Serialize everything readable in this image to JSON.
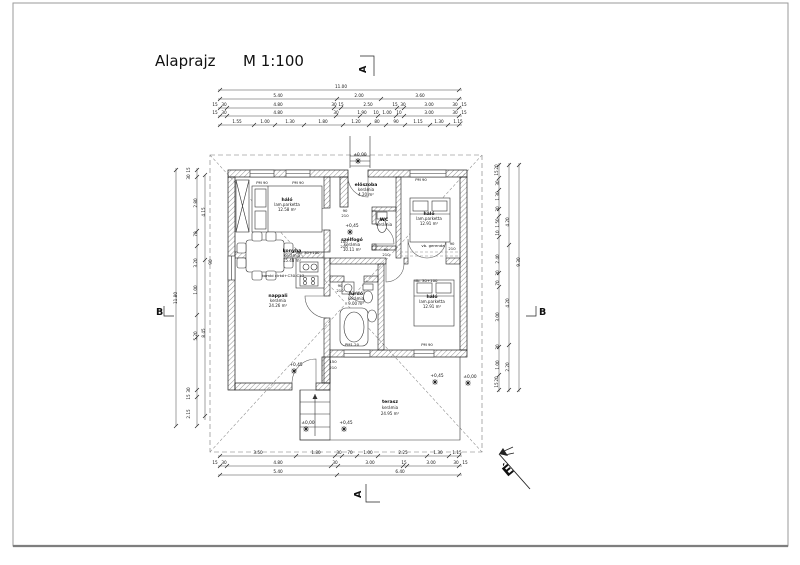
{
  "title": {
    "name": "Alaprajz",
    "scale": "M 1:100"
  },
  "section_labels": {
    "a": "A",
    "b": "B"
  },
  "north_label": "É",
  "rooms": [
    {
      "name": "háló",
      "floor": "lam.parketta",
      "area": "12.58 m²"
    },
    {
      "name": "előszoba",
      "floor": "kerámia",
      "area": "4.20 m²"
    },
    {
      "name": "háló",
      "floor": "lam.parketta",
      "area": "12.91 m²"
    },
    {
      "name": "WC",
      "floor": "kerámia",
      "area": ""
    },
    {
      "name": "szélfogó",
      "floor": "kerámia",
      "area": "10.11 m²"
    },
    {
      "name": "konyha",
      "floor": "kerámia",
      "area": "15.48 m²"
    },
    {
      "name": "nappali",
      "floor": "kerámia",
      "area": "24.26 m²"
    },
    {
      "name": "fürdő",
      "floor": "kerámia",
      "area": "9.00 m²"
    },
    {
      "name": "háló",
      "floor": "lam.parketta",
      "area": "12.91 m²"
    },
    {
      "name": "terasz",
      "floor": "kerámia",
      "area": "24.95 m²"
    }
  ],
  "window_labels": [
    {
      "t": "PM 90",
      "x": 262,
      "y": 184
    },
    {
      "t": "PM 90",
      "x": 298,
      "y": 184
    },
    {
      "t": "PM 90",
      "x": 421,
      "y": 181
    },
    {
      "t": "PM1.20",
      "x": 352,
      "y": 346
    },
    {
      "t": "PM 90",
      "x": 427,
      "y": 346
    }
  ],
  "elevation_marks": [
    {
      "t": "±0,00",
      "x": 360,
      "y": 156
    },
    {
      "t": "+0,45",
      "x": 352,
      "y": 227
    },
    {
      "t": "+0,45",
      "x": 296,
      "y": 366
    },
    {
      "t": "±0,00",
      "x": 308,
      "y": 424
    },
    {
      "t": "+0,45",
      "x": 346,
      "y": 424
    },
    {
      "t": "+0,45",
      "x": 437,
      "y": 377
    },
    {
      "t": "±0,00",
      "x": 470,
      "y": 378
    }
  ],
  "notes": [
    {
      "t": "vb. gerenda",
      "x": 433,
      "y": 247
    },
    {
      "t": "db. 30+100",
      "x": 308,
      "y": 254
    },
    {
      "t": "db. 30+100",
      "x": 426,
      "y": 282
    },
    {
      "t": "kombi cirkó+C30-C53",
      "x": 283,
      "y": 277
    }
  ],
  "door_sizes": [
    {
      "t": "90",
      "x": 345,
      "y": 212
    },
    {
      "t": "210",
      "x": 345,
      "y": 217
    },
    {
      "t": "100",
      "x": 344,
      "y": 243
    },
    {
      "t": "210",
      "x": 344,
      "y": 248
    },
    {
      "t": "90",
      "x": 386,
      "y": 251
    },
    {
      "t": "210",
      "x": 386,
      "y": 256
    },
    {
      "t": "90",
      "x": 452,
      "y": 245
    },
    {
      "t": "210",
      "x": 452,
      "y": 250
    },
    {
      "t": "90",
      "x": 340,
      "y": 287
    },
    {
      "t": "210",
      "x": 340,
      "y": 292
    },
    {
      "t": "150",
      "x": 333,
      "y": 363
    },
    {
      "t": "210",
      "x": 333,
      "y": 369
    }
  ],
  "dim_labels_h": [
    {
      "t": "11.00",
      "x": 341,
      "y": 88
    },
    {
      "t": "5.40",
      "x": 278,
      "y": 97
    },
    {
      "t": "2.00",
      "x": 359,
      "y": 97
    },
    {
      "t": "3.60",
      "x": 420,
      "y": 97
    },
    {
      "t": "15",
      "x": 215,
      "y": 106
    },
    {
      "t": "30",
      "x": 224,
      "y": 106
    },
    {
      "t": "4.80",
      "x": 278,
      "y": 106
    },
    {
      "t": "30",
      "x": 334,
      "y": 106
    },
    {
      "t": "15",
      "x": 341,
      "y": 106
    },
    {
      "t": "2.50",
      "x": 368,
      "y": 106
    },
    {
      "t": "15",
      "x": 395,
      "y": 106
    },
    {
      "t": "30",
      "x": 403,
      "y": 106
    },
    {
      "t": "3.00",
      "x": 429,
      "y": 106
    },
    {
      "t": "30",
      "x": 455,
      "y": 106
    },
    {
      "t": "15",
      "x": 464,
      "y": 106
    },
    {
      "t": "15",
      "x": 215,
      "y": 114
    },
    {
      "t": "30",
      "x": 224,
      "y": 114
    },
    {
      "t": "4.80",
      "x": 278,
      "y": 114
    },
    {
      "t": "30",
      "x": 336,
      "y": 114
    },
    {
      "t": "1.90",
      "x": 362,
      "y": 114
    },
    {
      "t": "10",
      "x": 376,
      "y": 114
    },
    {
      "t": "1.00",
      "x": 387,
      "y": 114
    },
    {
      "t": "10",
      "x": 399,
      "y": 114
    },
    {
      "t": "3.00",
      "x": 429,
      "y": 114
    },
    {
      "t": "30",
      "x": 455,
      "y": 114
    },
    {
      "t": "15",
      "x": 464,
      "y": 114
    },
    {
      "t": "1.55",
      "x": 237,
      "y": 123
    },
    {
      "t": "1.00",
      "x": 265,
      "y": 123
    },
    {
      "t": "1.30",
      "x": 290,
      "y": 123
    },
    {
      "t": "1.80",
      "x": 323,
      "y": 123
    },
    {
      "t": "1.20",
      "x": 356,
      "y": 123
    },
    {
      "t": "80",
      "x": 377,
      "y": 123
    },
    {
      "t": "90",
      "x": 396,
      "y": 123
    },
    {
      "t": "1.15",
      "x": 418,
      "y": 123
    },
    {
      "t": "1.30",
      "x": 439,
      "y": 123
    },
    {
      "t": "1.15",
      "x": 458,
      "y": 123
    },
    {
      "t": "3.50",
      "x": 258,
      "y": 454
    },
    {
      "t": "1.80",
      "x": 316,
      "y": 454
    },
    {
      "t": "30",
      "x": 339,
      "y": 454
    },
    {
      "t": "70",
      "x": 350,
      "y": 454
    },
    {
      "t": "1.00",
      "x": 368,
      "y": 454
    },
    {
      "t": "2.25",
      "x": 403,
      "y": 454
    },
    {
      "t": "1.30",
      "x": 438,
      "y": 454
    },
    {
      "t": "1.15",
      "x": 457,
      "y": 454
    },
    {
      "t": "15",
      "x": 215,
      "y": 464
    },
    {
      "t": "30",
      "x": 224,
      "y": 464
    },
    {
      "t": "4.80",
      "x": 278,
      "y": 464
    },
    {
      "t": "30",
      "x": 335,
      "y": 464
    },
    {
      "t": "3.00",
      "x": 370,
      "y": 464
    },
    {
      "t": "15",
      "x": 404,
      "y": 464
    },
    {
      "t": "3.00",
      "x": 431,
      "y": 464
    },
    {
      "t": "30",
      "x": 456,
      "y": 464
    },
    {
      "t": "15",
      "x": 465,
      "y": 464
    },
    {
      "t": "5.40",
      "x": 278,
      "y": 473
    },
    {
      "t": "6.40",
      "x": 400,
      "y": 473
    }
  ],
  "dim_labels_v": [
    {
      "t": "11.80",
      "x": 177,
      "y": 298
    },
    {
      "t": "15",
      "x": 190,
      "y": 170
    },
    {
      "t": "30",
      "x": 190,
      "y": 177
    },
    {
      "t": "2.80",
      "x": 197,
      "y": 203
    },
    {
      "t": "70",
      "x": 197,
      "y": 234
    },
    {
      "t": "3.20",
      "x": 197,
      "y": 263
    },
    {
      "t": "1.00",
      "x": 197,
      "y": 290
    },
    {
      "t": "5.20",
      "x": 197,
      "y": 336
    },
    {
      "t": "30",
      "x": 190,
      "y": 390
    },
    {
      "t": "15",
      "x": 190,
      "y": 397
    },
    {
      "t": "2.15",
      "x": 190,
      "y": 414
    },
    {
      "t": "4.15",
      "x": 205,
      "y": 212
    },
    {
      "t": "8.45",
      "x": 205,
      "y": 333
    },
    {
      "t": "90",
      "x": 212,
      "y": 262
    },
    {
      "t": "9.30",
      "x": 520,
      "y": 262
    },
    {
      "t": "20",
      "x": 498,
      "y": 167
    },
    {
      "t": "15",
      "x": 498,
      "y": 173
    },
    {
      "t": "30",
      "x": 499,
      "y": 183
    },
    {
      "t": "1.30",
      "x": 499,
      "y": 196
    },
    {
      "t": "30",
      "x": 499,
      "y": 209
    },
    {
      "t": "1.50",
      "x": 499,
      "y": 223
    },
    {
      "t": "10",
      "x": 499,
      "y": 233
    },
    {
      "t": "2.40",
      "x": 499,
      "y": 259
    },
    {
      "t": "30",
      "x": 499,
      "y": 273
    },
    {
      "t": "70",
      "x": 499,
      "y": 283
    },
    {
      "t": "3.00",
      "x": 499,
      "y": 317
    },
    {
      "t": "30",
      "x": 499,
      "y": 347
    },
    {
      "t": "1.00",
      "x": 499,
      "y": 365
    },
    {
      "t": "20",
      "x": 498,
      "y": 379
    },
    {
      "t": "15",
      "x": 498,
      "y": 385
    },
    {
      "t": "4.20",
      "x": 509,
      "y": 222
    },
    {
      "t": "4.20",
      "x": 509,
      "y": 303
    },
    {
      "t": "2.20",
      "x": 509,
      "y": 367
    }
  ]
}
